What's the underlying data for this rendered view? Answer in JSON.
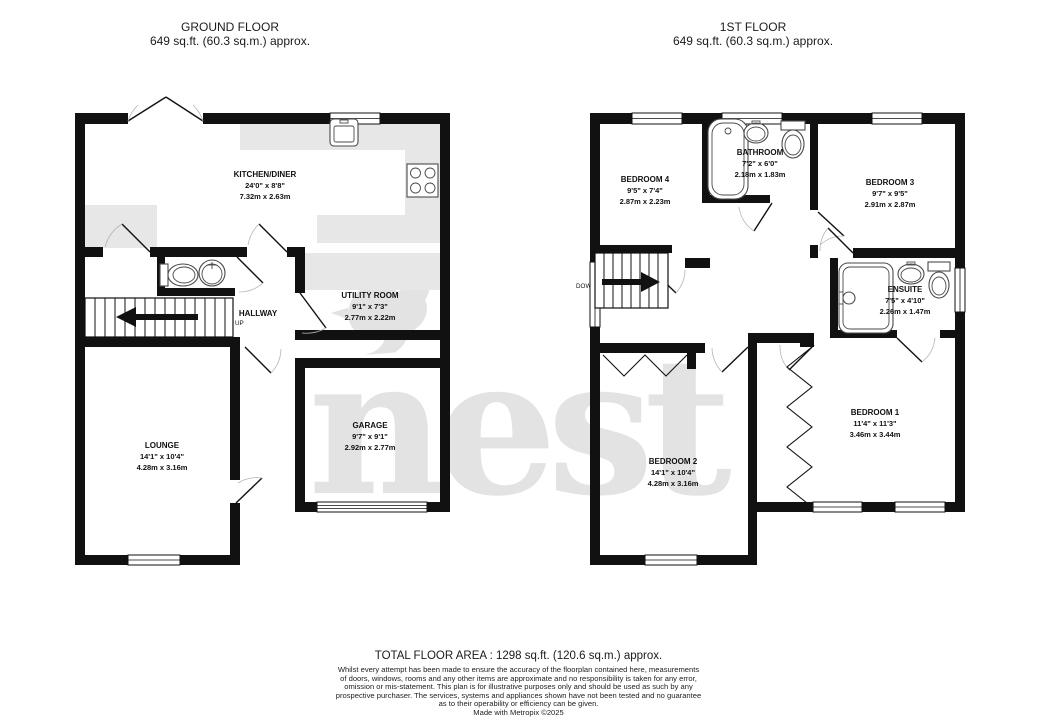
{
  "watermark": {
    "text": "nest"
  },
  "ground_floor": {
    "title": "GROUND FLOOR",
    "subtitle": "649 sq.ft. (60.3 sq.m.) approx.",
    "stairs_label": "UP",
    "rooms": {
      "kitchen": {
        "name": "KITCHEN/DINER",
        "imperial": "24'0\" x 8'8\"",
        "metric": "7.32m x 2.63m"
      },
      "hallway": {
        "name": "HALLWAY"
      },
      "utility": {
        "name": "UTILITY ROOM",
        "imperial": "9'1\" x 7'3\"",
        "metric": "2.77m x 2.22m"
      },
      "lounge": {
        "name": "LOUNGE",
        "imperial": "14'1\" x 10'4\"",
        "metric": "4.28m x 3.16m"
      },
      "garage": {
        "name": "GARAGE",
        "imperial": "9'7\" x 9'1\"",
        "metric": "2.92m x 2.77m"
      }
    }
  },
  "first_floor": {
    "title": "1ST FLOOR",
    "subtitle": "649 sq.ft. (60.3 sq.m.) approx.",
    "stairs_label": "DOWN",
    "rooms": {
      "bedroom4": {
        "name": "BEDROOM 4",
        "imperial": "9'5\" x 7'4\"",
        "metric": "2.87m x 2.23m"
      },
      "bathroom": {
        "name": "BATHROOM",
        "imperial": "7'2\" x 6'0\"",
        "metric": "2.18m x 1.83m"
      },
      "bedroom3": {
        "name": "BEDROOM 3",
        "imperial": "9'7\" x 9'5\"",
        "metric": "2.91m x 2.87m"
      },
      "ensuite": {
        "name": "ENSUITE",
        "imperial": "7'5\" x 4'10\"",
        "metric": "2.26m x 1.47m"
      },
      "bedroom1": {
        "name": "BEDROOM 1",
        "imperial": "11'4\" x 11'3\"",
        "metric": "3.46m x 3.44m"
      },
      "bedroom2": {
        "name": "BEDROOM 2",
        "imperial": "14'1\" x 10'4\"",
        "metric": "4.28m x 3.16m"
      }
    }
  },
  "footer": {
    "total_area": "TOTAL FLOOR AREA : 1298 sq.ft. (120.6 sq.m.) approx.",
    "disclaimer": [
      "Whilst every attempt has been made to ensure the accuracy of the floorplan contained here, measurements",
      "of doors, windows, rooms and any other items are approximate and no responsibility is taken for any error,",
      "omission or mis-statement. This plan is for illustrative purposes only and should be used as such by any",
      "prospective purchaser. The services, systems and appliances shown have not been tested and no guarantee",
      "as to their operability or efficiency can be given."
    ],
    "credit": "Made with Metropix ©2025"
  }
}
